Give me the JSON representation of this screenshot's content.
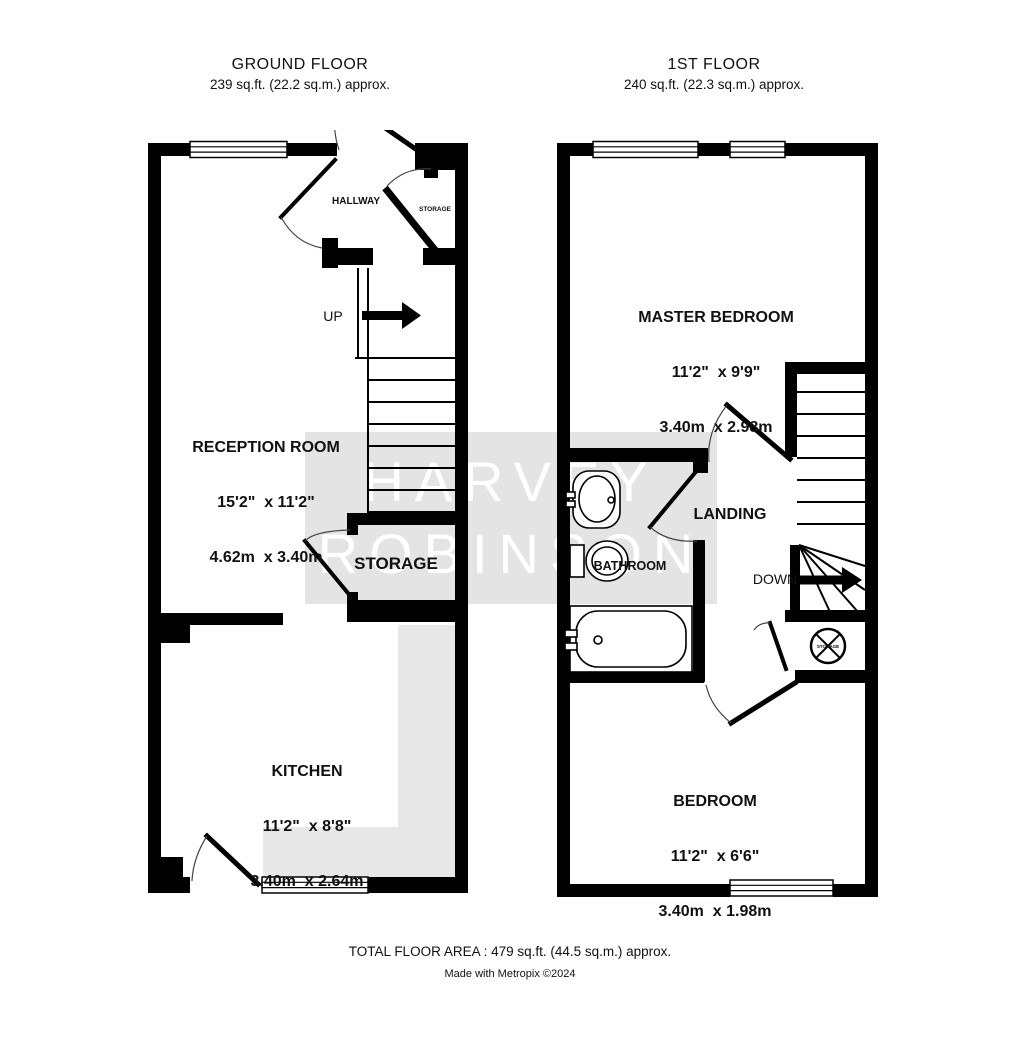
{
  "ground_floor": {
    "title": "GROUND FLOOR",
    "area": "239 sq.ft. (22.2 sq.m.) approx.",
    "hallway": {
      "name": "HALLWAY"
    },
    "hall_storage": {
      "name": "STORAGE"
    },
    "reception": {
      "name": "RECEPTION ROOM",
      "dims_imperial": "15'2\"  x 11'2\"",
      "dims_metric": "4.62m  x 3.40m"
    },
    "storage": {
      "name": "STORAGE"
    },
    "kitchen": {
      "name": "KITCHEN",
      "dims_imperial": "11'2\"  x 8'8\"",
      "dims_metric": "3.40m  x 2.64m"
    },
    "stairs": {
      "direction_label": "UP"
    }
  },
  "first_floor": {
    "title": "1ST FLOOR",
    "area": "240 sq.ft. (22.3 sq.m.) approx.",
    "master_bedroom": {
      "name": "MASTER BEDROOM",
      "dims_imperial": "11'2\"  x 9'9\"",
      "dims_metric": "3.40m  x 2.98m"
    },
    "landing": {
      "name": "LANDING"
    },
    "bathroom": {
      "name": "BATHROOM"
    },
    "bedroom": {
      "name": "BEDROOM",
      "dims_imperial": "11'2\"  x 6'6\"",
      "dims_metric": "3.40m  x 1.98m"
    },
    "cylinder": {
      "label": "STORAGE"
    },
    "stairs": {
      "direction_label": "DOWN"
    }
  },
  "watermark": {
    "line1": "HARVEY",
    "line2": "ROBINSON"
  },
  "footer": {
    "total_area": "TOTAL FLOOR AREA : 479 sq.ft. (44.5 sq.m.) approx.",
    "credit": "Made with Metropix ©2024"
  },
  "colors": {
    "wall": "#000000",
    "counter_fill": "#e7e7e7",
    "watermark_bg": "#e4e4e4",
    "watermark_text": "#ffffff",
    "text": "#111111"
  }
}
